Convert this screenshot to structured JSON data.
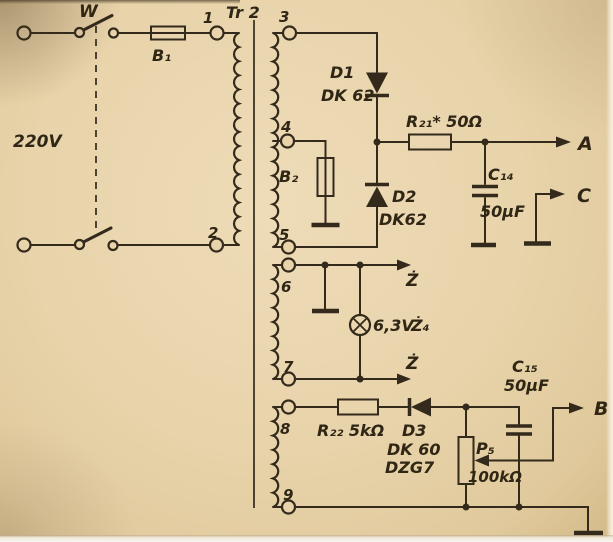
{
  "diagram": {
    "description": "Scanned schematic of a transformer power supply (Tr 2) with full-wave rectifier, bias supply and heater winding",
    "mains": {
      "voltage_label": "220V"
    },
    "switch": {
      "label": "W"
    },
    "fuse_primary": {
      "label": "B₁"
    },
    "fuse_secondary": {
      "label": "B₂"
    },
    "transformer": {
      "label": "Tr 2",
      "terminals": [
        "1",
        "2",
        "3",
        "4",
        "5",
        "6",
        "7",
        "8",
        "9"
      ]
    },
    "diode_d1": {
      "name": "D1",
      "type": "DK 62"
    },
    "diode_d2": {
      "name": "D2",
      "type": "DK62"
    },
    "diode_d3": {
      "name": "D3",
      "type_line1": "DK 60",
      "type_line2": "DZG7"
    },
    "resistor_r21": {
      "label": "R₂₁* 50Ω"
    },
    "resistor_r22": {
      "label": "R₂₂ 5kΩ"
    },
    "capacitor_c14": {
      "name": "C₁₄",
      "value": "50µF"
    },
    "capacitor_c15": {
      "name": "C₁₅",
      "value": "50µF"
    },
    "potentiometer_p5": {
      "name": "P₅",
      "value": "100kΩ"
    },
    "lamp": {
      "rating": "6,3V",
      "name": "Ż₄"
    },
    "outputs": {
      "a": "A",
      "b": "B",
      "c": "C",
      "heater_top": "Ż",
      "heater_bottom": "Ż"
    },
    "colors": {
      "paper": "#e8d3aa",
      "ink": "#332a1b"
    }
  }
}
